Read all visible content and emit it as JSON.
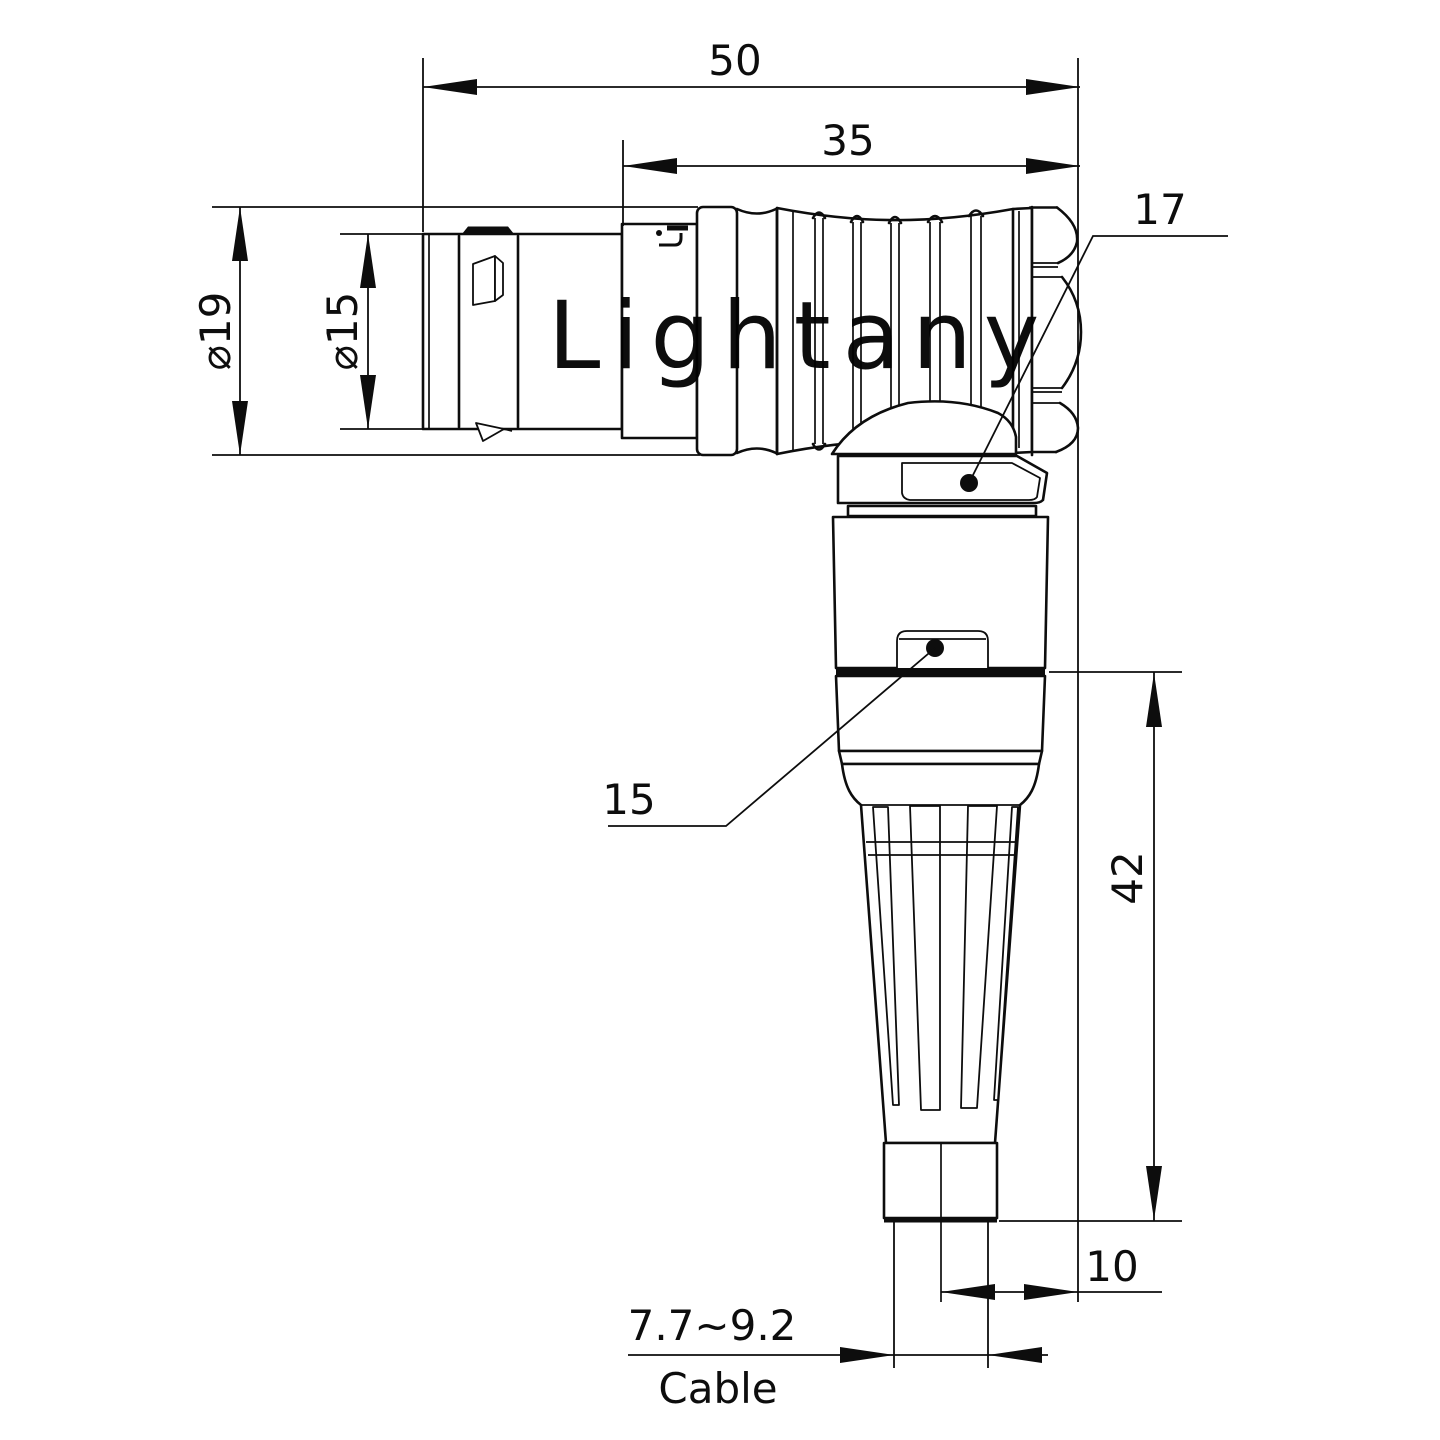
{
  "drawing": {
    "type": "technical-dimension-drawing",
    "subject": "right-angle circular push-pull connector with bend relief, side view",
    "background_color": "#ffffff",
    "line_color": "#0d0d0d",
    "watermark": {
      "text": "Lightany",
      "color": "#f3cccc"
    },
    "dimensions": {
      "overall_length": "50",
      "grip_length": "35",
      "outer_diameter": "⌀19",
      "barrel_diameter": "⌀15",
      "vertical_length": "42",
      "cable_offset": "10",
      "cable_diameter_range": "7.7~9.2",
      "cable_label": "Cable"
    },
    "callouts": {
      "nut_across_flats": "17",
      "body_across_flats": "15"
    }
  }
}
